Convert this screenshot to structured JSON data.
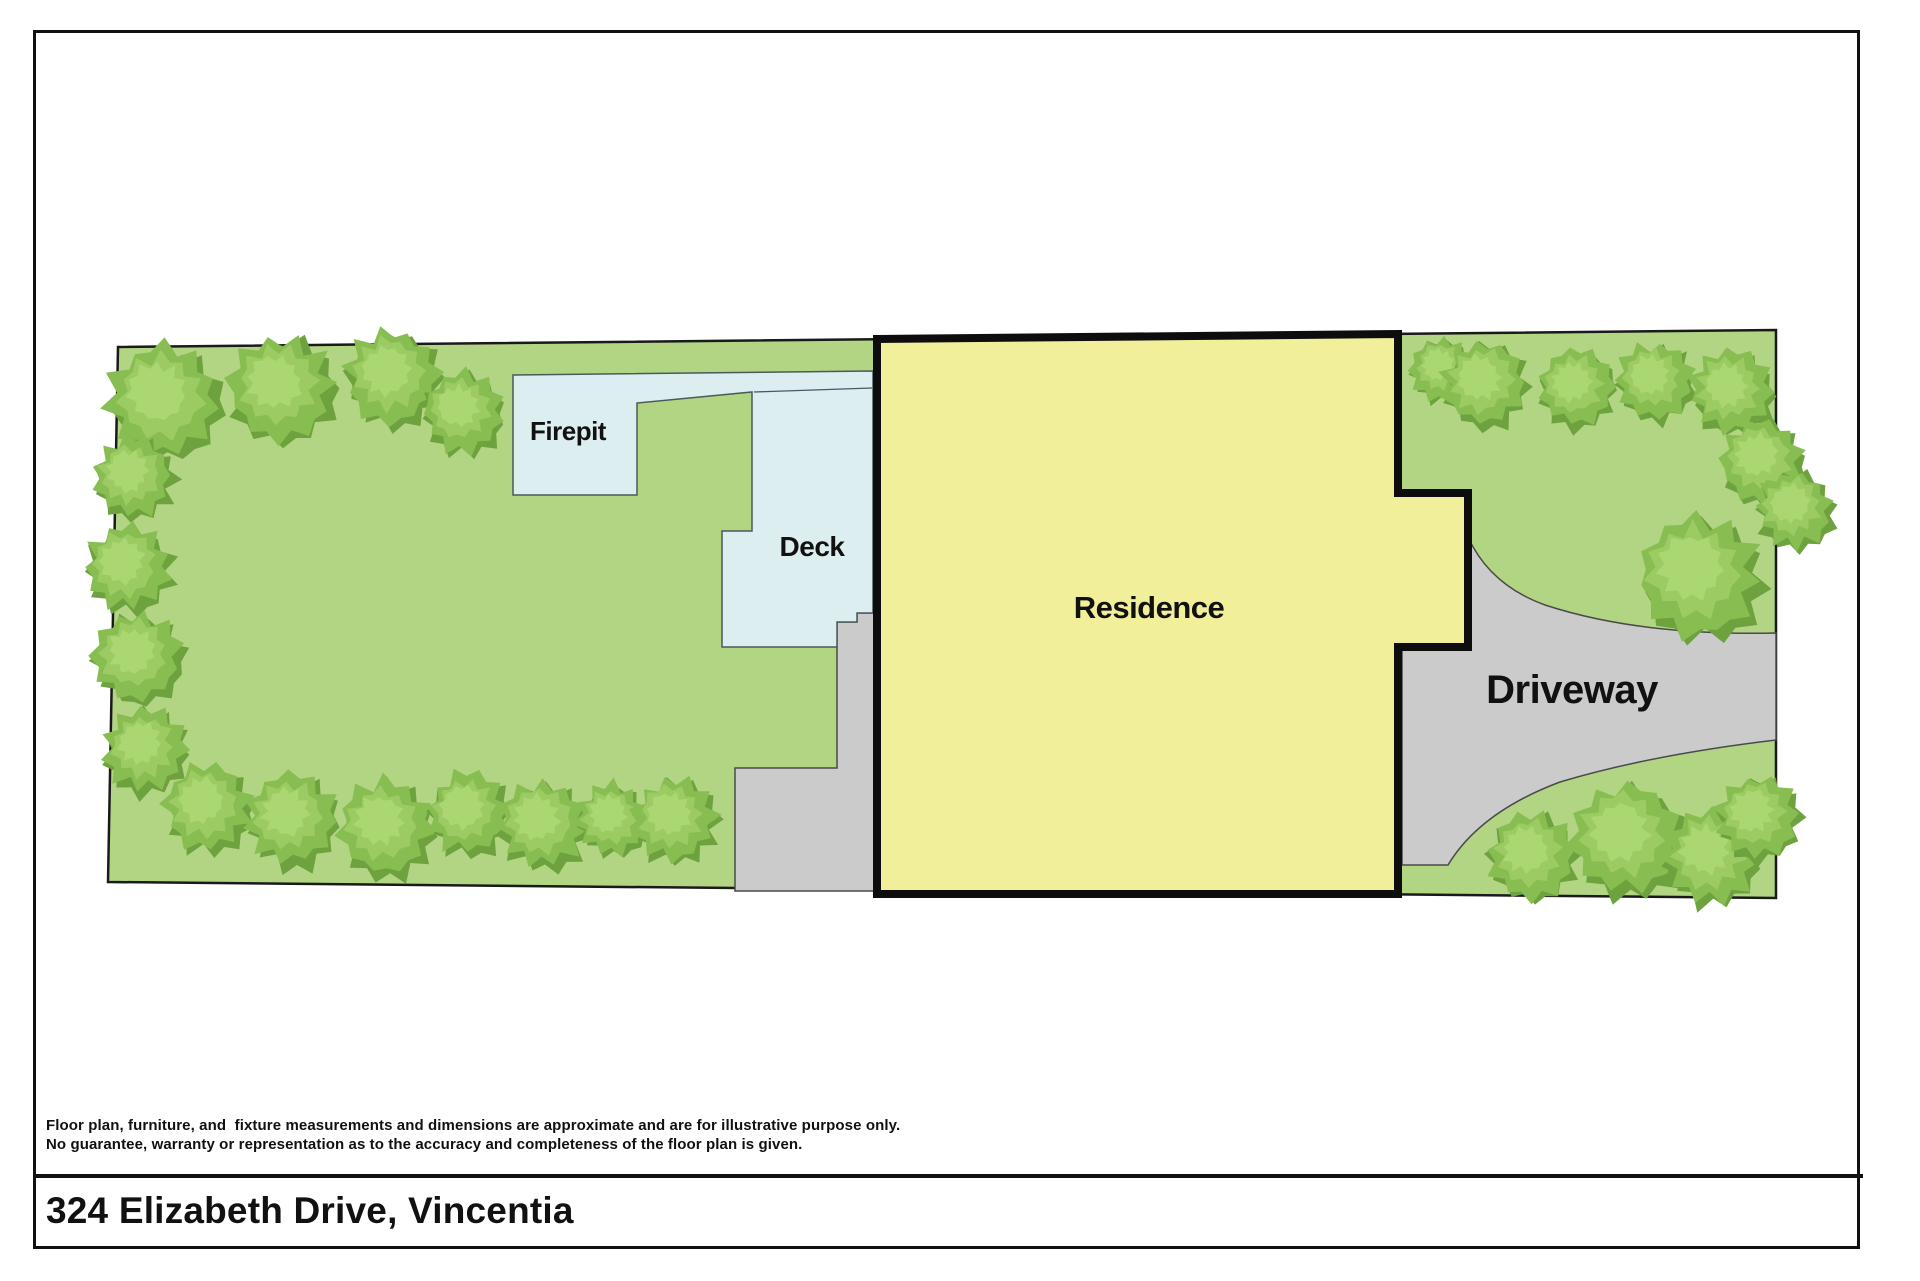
{
  "footer": {
    "disclaimer_line1": "Floor plan, furniture, and  fixture measurements and dimensions are approximate and are for illustrative purpose only.",
    "disclaimer_line2": "No guarantee, warranty or representation as to the accuracy and completeness of the floor plan is given.",
    "address": "324 Elizabeth Drive, Vincentia"
  },
  "plan": {
    "labels": {
      "firepit": {
        "text": "Firepit",
        "x": 568,
        "y": 440,
        "size": 26
      },
      "deck": {
        "text": "Deck",
        "x": 812,
        "y": 556,
        "size": 28
      },
      "residence": {
        "text": "Residence",
        "x": 1149,
        "y": 618,
        "size": 31
      },
      "driveway": {
        "text": "Driveway",
        "x": 1572,
        "y": 703,
        "size": 40
      }
    },
    "colors": {
      "lawn": "#b2d584",
      "lot_stroke": "#1a1a1a",
      "structure_blue": "#dceef0",
      "structure_stroke": "#4a5a5c",
      "residence_yellow": "#f2ef9b",
      "residence_stroke": "#0d0d0d",
      "paving_gray": "#cbcbcb",
      "paving_stroke": "#4a4a4a",
      "tree_dark": "#6da23f",
      "tree_mid": "#88bd52",
      "tree_light": "#9ccb63",
      "tree_lighter": "#abd773",
      "label_color": "#111111"
    },
    "lot_points": [
      [
        118,
        347
      ],
      [
        1776,
        330
      ],
      [
        1776,
        898
      ],
      [
        108,
        882
      ]
    ],
    "residence_points": [
      [
        877,
        339
      ],
      [
        1398,
        334
      ],
      [
        1398,
        493
      ],
      [
        1468,
        493
      ],
      [
        1468,
        647
      ],
      [
        1398,
        647
      ],
      [
        1398,
        894
      ],
      [
        877,
        894
      ]
    ],
    "deck_points": [
      [
        513,
        375
      ],
      [
        873,
        371
      ],
      [
        873,
        613
      ],
      [
        857,
        613
      ],
      [
        857,
        622
      ],
      [
        837,
        622
      ],
      [
        837,
        647
      ],
      [
        722,
        647
      ],
      [
        722,
        531
      ],
      [
        752,
        531
      ],
      [
        752,
        392
      ],
      [
        637,
        403
      ],
      [
        637,
        495
      ],
      [
        513,
        495
      ]
    ],
    "deck_divider": {
      "x1": 754,
      "y1": 392,
      "x2": 872,
      "y2": 388
    },
    "walkway_points": [
      [
        857,
        613
      ],
      [
        877,
        613
      ],
      [
        877,
        891
      ],
      [
        735,
        891
      ],
      [
        735,
        768
      ],
      [
        837,
        768
      ],
      [
        837,
        622
      ],
      [
        857,
        622
      ]
    ],
    "driveway_path": "M1468,537 Q1490,585 1545,605 Q1640,636 1776,633 L1776,740 Q1650,755 1560,782 Q1480,812 1448,865 L1402,865 L1402,647 L1468,647 Z",
    "trees": [
      {
        "cx": 165,
        "cy": 402,
        "r": 62
      },
      {
        "cx": 282,
        "cy": 390,
        "r": 58
      },
      {
        "cx": 393,
        "cy": 378,
        "r": 52
      },
      {
        "cx": 463,
        "cy": 413,
        "r": 44
      },
      {
        "cx": 133,
        "cy": 478,
        "r": 44
      },
      {
        "cx": 128,
        "cy": 568,
        "r": 47
      },
      {
        "cx": 138,
        "cy": 658,
        "r": 49
      },
      {
        "cx": 146,
        "cy": 750,
        "r": 46
      },
      {
        "cx": 208,
        "cy": 808,
        "r": 48
      },
      {
        "cx": 292,
        "cy": 820,
        "r": 50
      },
      {
        "cx": 386,
        "cy": 828,
        "r": 52
      },
      {
        "cx": 468,
        "cy": 814,
        "r": 45
      },
      {
        "cx": 543,
        "cy": 825,
        "r": 48
      },
      {
        "cx": 613,
        "cy": 820,
        "r": 40
      },
      {
        "cx": 675,
        "cy": 820,
        "r": 46
      },
      {
        "cx": 1442,
        "cy": 370,
        "r": 34
      },
      {
        "cx": 1485,
        "cy": 385,
        "r": 46
      },
      {
        "cx": 1577,
        "cy": 388,
        "r": 42
      },
      {
        "cx": 1655,
        "cy": 382,
        "r": 42
      },
      {
        "cx": 1732,
        "cy": 392,
        "r": 45
      },
      {
        "cx": 1762,
        "cy": 462,
        "r": 46
      },
      {
        "cx": 1795,
        "cy": 510,
        "r": 42
      },
      {
        "cx": 1700,
        "cy": 577,
        "r": 67
      },
      {
        "cx": 1532,
        "cy": 857,
        "r": 48
      },
      {
        "cx": 1628,
        "cy": 840,
        "r": 62
      },
      {
        "cx": 1712,
        "cy": 857,
        "r": 52
      },
      {
        "cx": 1758,
        "cy": 818,
        "r": 45
      }
    ]
  }
}
